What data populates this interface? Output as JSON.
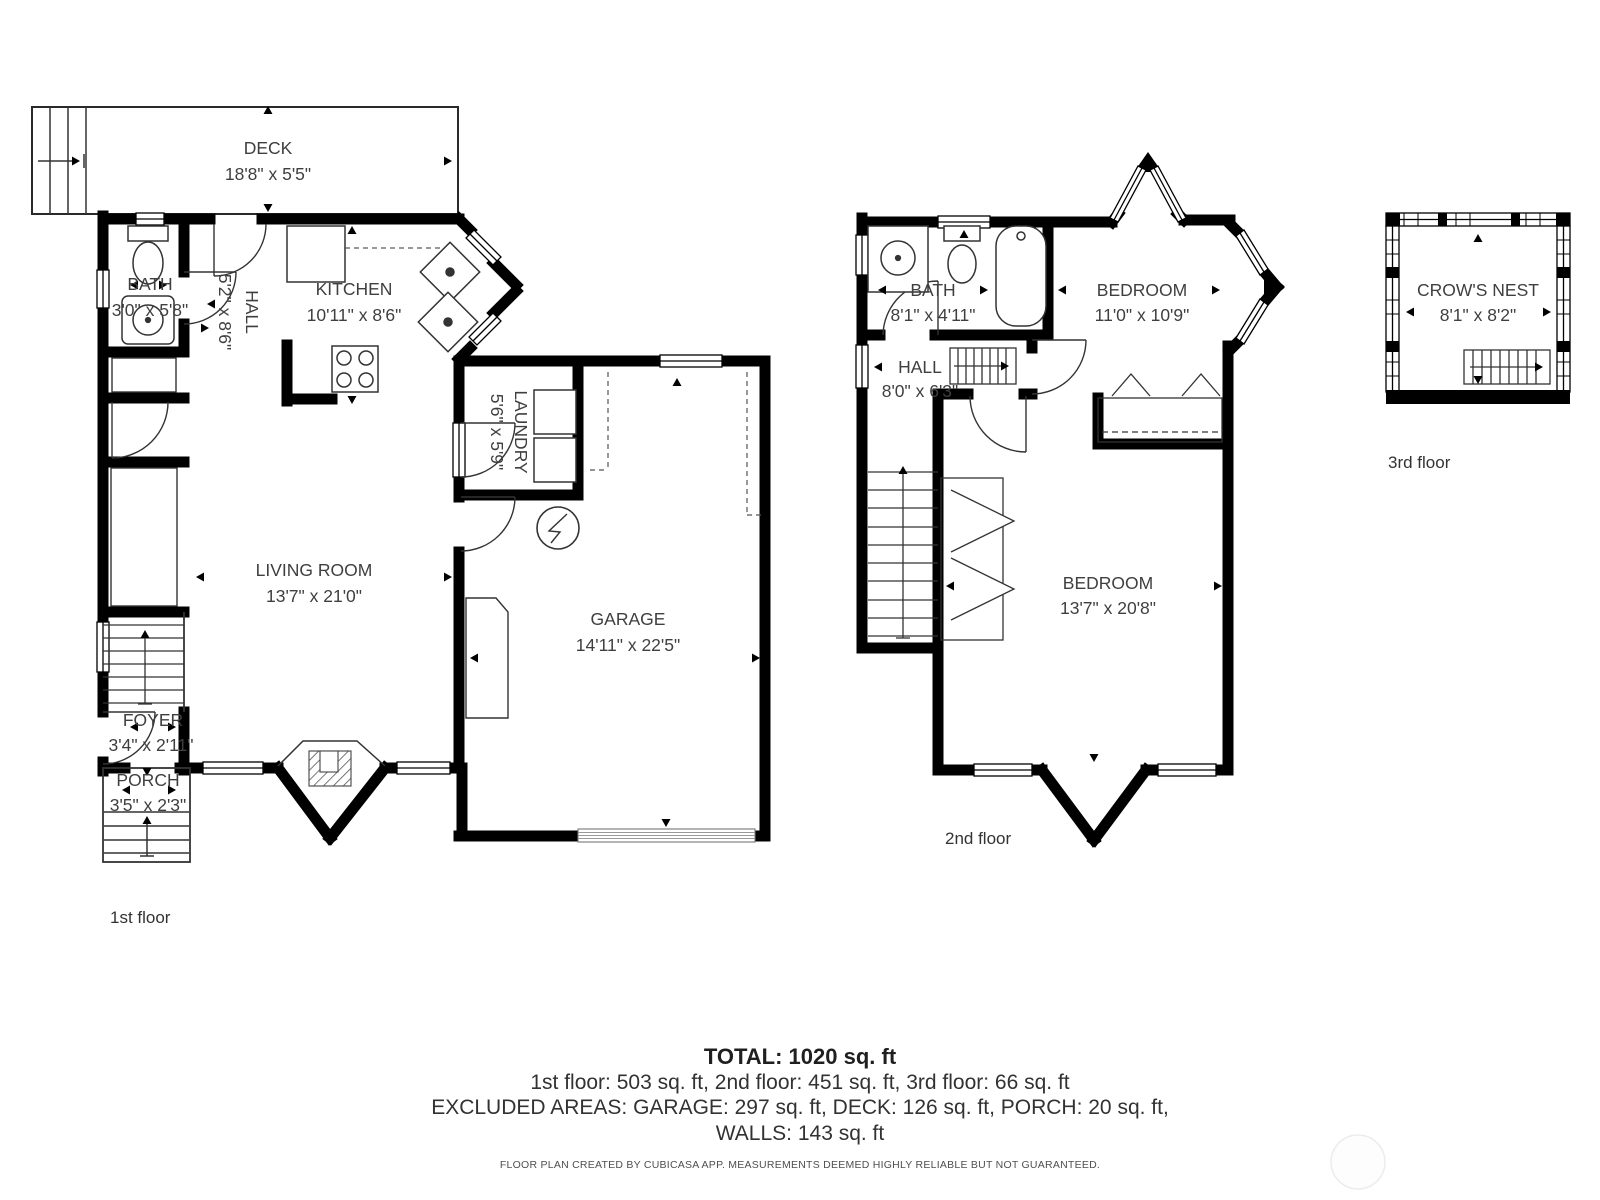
{
  "colors": {
    "wall": "#000000",
    "room_text": "#3f3f3f",
    "summary_text": "#323232",
    "footer_text": "#4f4f4f"
  },
  "floors": [
    {
      "caption": "1st floor",
      "rooms": [
        {
          "name": "DECK",
          "dims": "18'8\" x 5'5\""
        },
        {
          "name": "BATH",
          "dims": "3'0\" x 5'8\""
        },
        {
          "name": "HALL",
          "dims": "5'2\" x 8'6\""
        },
        {
          "name": "KITCHEN",
          "dims": "10'11\" x 8'6\""
        },
        {
          "name": "LIVING ROOM",
          "dims": "13'7\" x 21'0\""
        },
        {
          "name": "LAUNDRY",
          "dims": "5'6\" x 5'9\""
        },
        {
          "name": "GARAGE",
          "dims": "14'11\" x 22'5\""
        },
        {
          "name": "FOYER",
          "dims": "3'4\" x 2'11\""
        },
        {
          "name": "PORCH",
          "dims": "3'5\" x 2'3\""
        }
      ]
    },
    {
      "caption": "2nd floor",
      "rooms": [
        {
          "name": "BATH",
          "dims": "8'1\" x 4'11\""
        },
        {
          "name": "BEDROOM",
          "dims": "11'0\" x 10'9\""
        },
        {
          "name": "HALL",
          "dims": "8'0\" x 6'3\""
        },
        {
          "name": "BEDROOM",
          "dims": "13'7\" x 20'8\""
        }
      ]
    },
    {
      "caption": "3rd floor",
      "rooms": [
        {
          "name": "CROW'S NEST",
          "dims": "8'1\" x 8'2\""
        }
      ]
    }
  ],
  "summary": {
    "total": "TOTAL: 1020 sq. ft",
    "floors_line": "1st floor: 503 sq. ft, 2nd floor: 451 sq. ft, 3rd floor: 66 sq. ft",
    "excluded_line": "EXCLUDED AREAS: GARAGE: 297 sq. ft, DECK: 126 sq. ft, PORCH: 20 sq. ft,",
    "walls_line": "WALLS: 143 sq. ft"
  },
  "footer": {
    "disclaimer": "FLOOR PLAN CREATED BY CUBICASA APP. MEASUREMENTS DEEMED HIGHLY RELIABLE BUT NOT GUARANTEED."
  }
}
